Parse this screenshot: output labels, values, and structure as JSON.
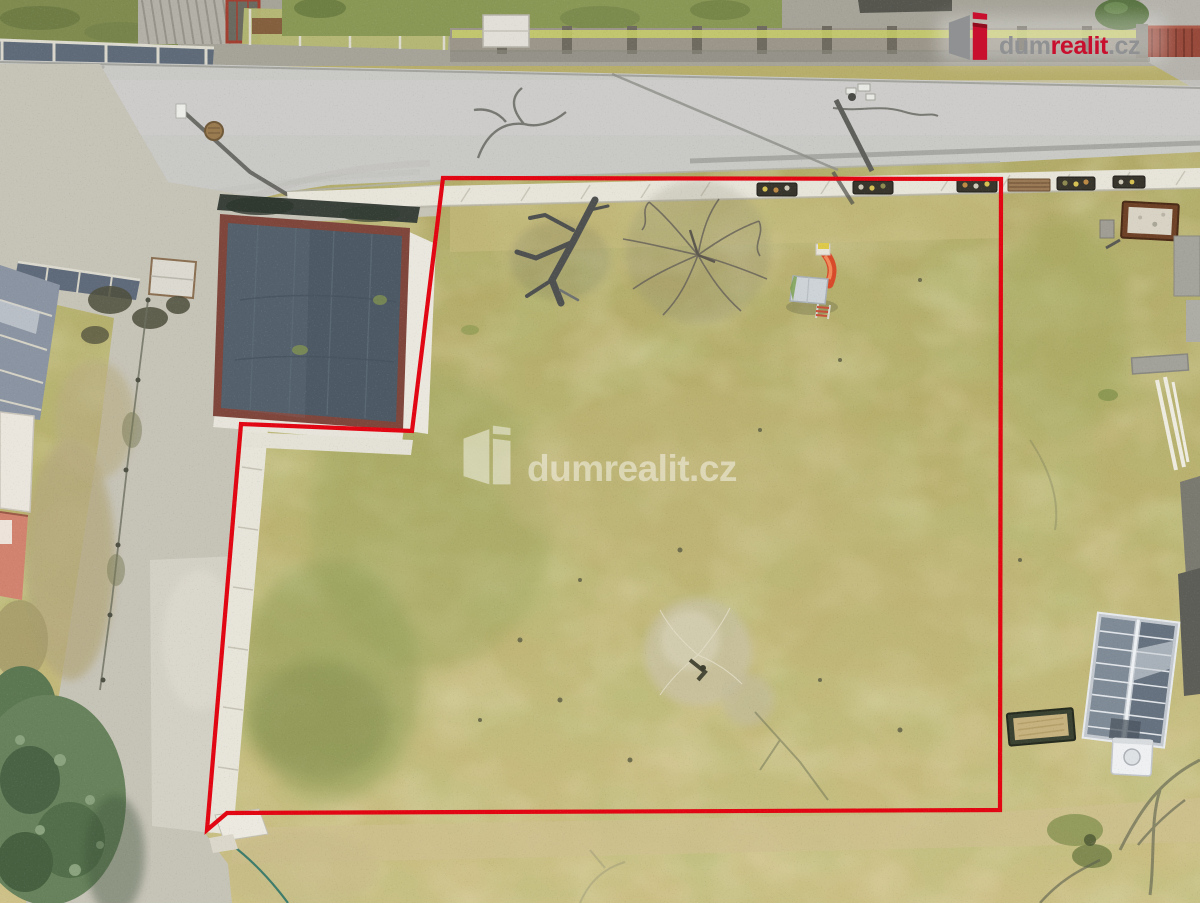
{
  "photo": {
    "description": "aerial drone view of a land plot for sale with red boundary outline",
    "boundary": {
      "color": "#e20613",
      "points": "443,178 1001,179 1000,810 227,813 207,830 241,424 412,431"
    }
  },
  "brand": {
    "red": "#c8102e",
    "dark_red": "#8e0e1f",
    "gray": "#8f9193",
    "white": "#ffffff"
  },
  "icons": {
    "brand_mark": "dumrealit-building-mark"
  },
  "header_logo": {
    "dum": "dum",
    "realit": "realit",
    "cz": ".cz"
  },
  "watermark": {
    "dum": "dum",
    "realit": "realit",
    "cz": ".cz"
  }
}
